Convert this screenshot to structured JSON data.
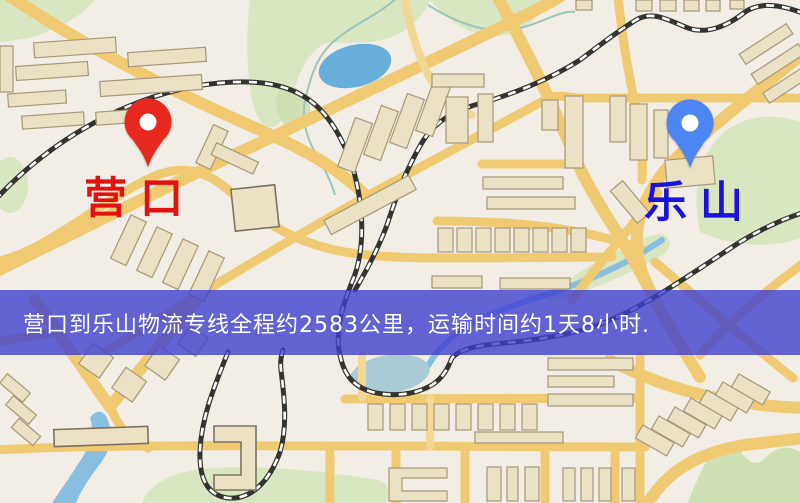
{
  "page": {
    "width": 800,
    "height": 503
  },
  "theme": {
    "map_bg": "#f2eee5",
    "road": "#f0ca72",
    "road_minor": "#f3d795",
    "building_fill": "#ebe2c6",
    "building_stroke": "#a79878",
    "railway_dark": "#333330",
    "railway_light": "#ffffff",
    "green": "#d9e6c2",
    "green_dark": "#cfe0b4",
    "water": "#68aeda",
    "water_light": "#a9ccd4",
    "river": "#8abede",
    "stream": "#9cc4bd"
  },
  "markers": {
    "origin": {
      "label": "营口",
      "pin_color": "#e6281e",
      "label_color": "#e01310"
    },
    "destination": {
      "label": "乐山",
      "pin_color": "#4d86f2",
      "label_color": "#1b13dd"
    }
  },
  "banner": {
    "text": "营口到乐山物流专线全程约2583公里，运输时间约1天8小时.",
    "bg": "rgba(62,62,206,0.8)",
    "text_color": "#ffffff"
  }
}
